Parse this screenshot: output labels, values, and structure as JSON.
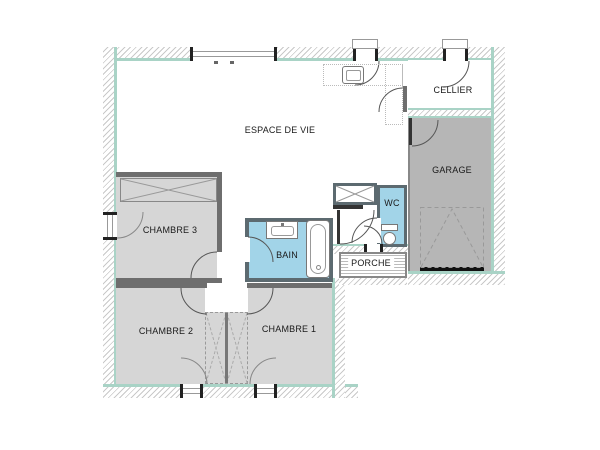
{
  "rooms": {
    "living": {
      "label": "ESPACE DE VIE"
    },
    "cellier": {
      "label": "CELLIER"
    },
    "garage": {
      "label": "GARAGE"
    },
    "wc": {
      "label": "WC"
    },
    "bath": {
      "label": "BAIN"
    },
    "porch": {
      "label": "PORCHE"
    },
    "bedroom3": {
      "label": "CHAMBRE 3"
    },
    "bedroom2": {
      "label": "CHAMBRE 2"
    },
    "bedroom1": {
      "label": "CHAMBRE 1"
    }
  },
  "colors": {
    "wall_hatch_line": "#c9c9c9",
    "insulation": "#a9d3c6",
    "bedroom_fill": "#d6d6d6",
    "garage_fill": "#b6b6b6",
    "wet_room_fill": "#a2d4e8",
    "wall_dark": "#5c6a70",
    "interior_wall": "#6e6e6e",
    "line": "#555555",
    "text": "#1a1a1a"
  }
}
